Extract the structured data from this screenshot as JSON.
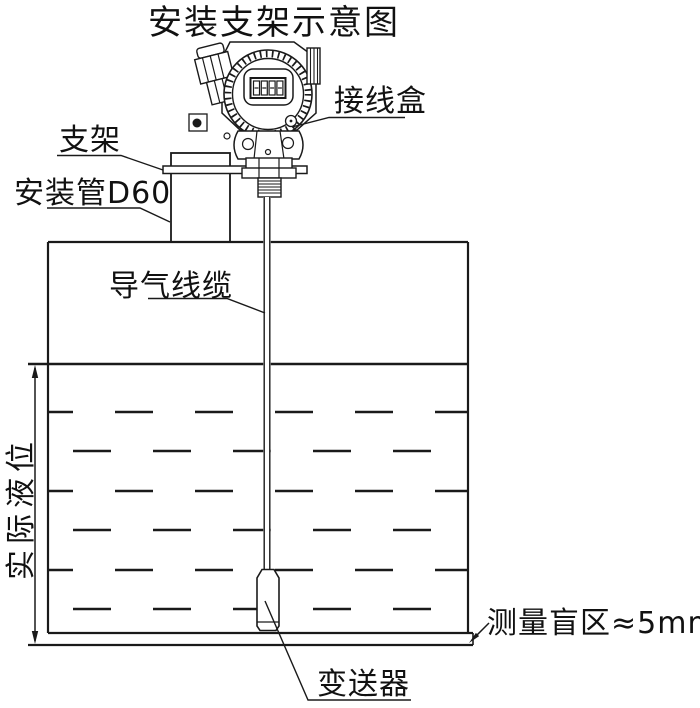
{
  "meta": {
    "type": "technical-installation-diagram",
    "background_color": "#ffffff",
    "line_color": "#1a1a1a"
  },
  "title": "安装支架示意图",
  "labels": {
    "junction_box": "接线盒",
    "bracket": "支架",
    "mounting_pipe": "安装管D60",
    "air_cable": "导气线缆",
    "actual_level": "实际液位",
    "blind_zone": "测量盲区≈5mm",
    "transmitter": "变送器"
  },
  "lcd_display": "8888"
}
